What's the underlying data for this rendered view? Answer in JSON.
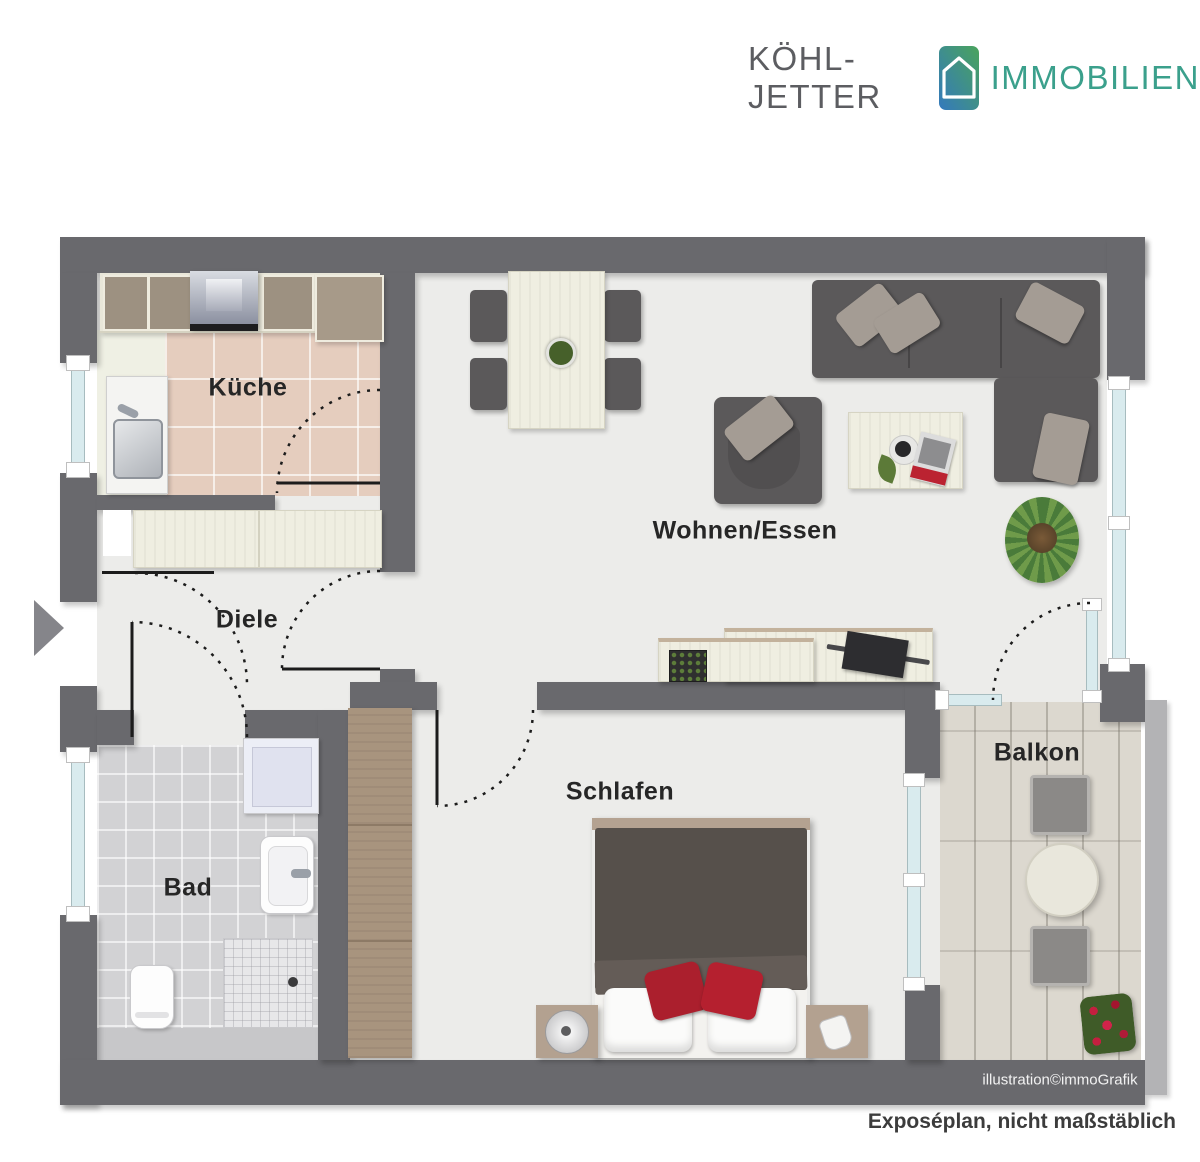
{
  "branding": {
    "company_primary": "KÖHL-JETTER",
    "company_secondary": "IMMOBILIEN",
    "logo_icon": "house-icon",
    "logo_gradient_start": "#3479bd",
    "logo_gradient_end": "#4aa45c",
    "secondary_color": "#3ba08c"
  },
  "rooms": [
    {
      "id": "kueche",
      "label": "Küche"
    },
    {
      "id": "wohnen-essen",
      "label": "Wohnen/Essen"
    },
    {
      "id": "diele",
      "label": "Diele"
    },
    {
      "id": "bad",
      "label": "Bad"
    },
    {
      "id": "schlafen",
      "label": "Schlafen"
    },
    {
      "id": "balkon",
      "label": "Balkon"
    }
  ],
  "annotations": {
    "credit": "illustration©immoGrafik",
    "disclaimer": "Exposéplan, nicht maßstäblich"
  },
  "colors": {
    "wall": "#69696d",
    "floor": "#ececea",
    "window_glass": "#d9ebee",
    "accent_red": "#b5202f"
  }
}
